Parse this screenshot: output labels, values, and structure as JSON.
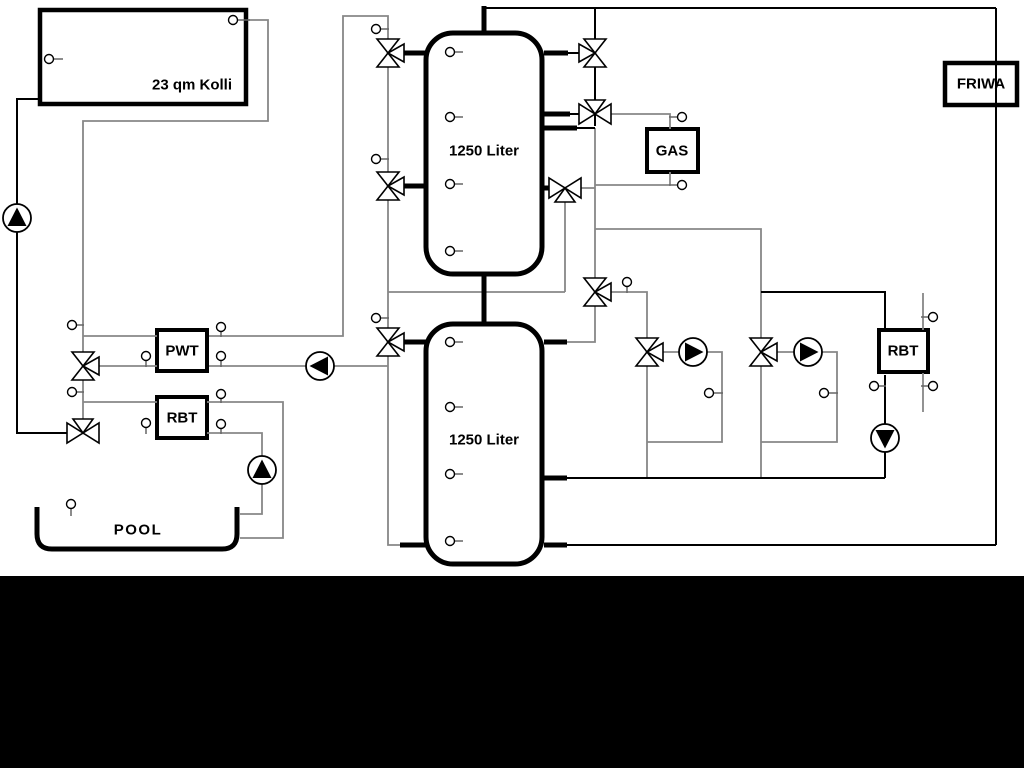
{
  "page": {
    "background": "#ffffff",
    "footer_bar_color": "#000000",
    "pipe_gray": "#878787",
    "pipe_black": "#000000",
    "component_fill": "#ffffff"
  },
  "diagram": {
    "labels": {
      "collector": "23 qm Kolli",
      "tank_top": "1250 Liter",
      "tank_bottom": "1250 Liter",
      "pwt": "PWT",
      "rbt_left": "RBT",
      "gas": "GAS",
      "friwa": "FRIWA",
      "rbt_right": "RBT",
      "pool": "POOL"
    },
    "components": {
      "pumps": [
        {
          "name": "solar-pump",
          "x": 17,
          "y": 218,
          "dir": "up"
        },
        {
          "name": "pwt-pump",
          "x": 320,
          "y": 366,
          "dir": "left"
        },
        {
          "name": "pool-pump",
          "x": 262,
          "y": 470,
          "dir": "up"
        },
        {
          "name": "heating-pump-1",
          "x": 693,
          "y": 352,
          "dir": "right"
        },
        {
          "name": "heating-pump-2",
          "x": 808,
          "y": 352,
          "dir": "right"
        },
        {
          "name": "rbt-pump",
          "x": 885,
          "y": 438,
          "dir": "down"
        }
      ],
      "valves": [
        {
          "name": "valve-buffer1-left-top",
          "x": 388,
          "y": 53,
          "t": "vR"
        },
        {
          "name": "valve-buffer1-left-mid",
          "x": 388,
          "y": 186,
          "t": "vR"
        },
        {
          "name": "valve-buffer2-left",
          "x": 388,
          "y": 342,
          "t": "vR"
        },
        {
          "name": "valve-solar-pwt",
          "x": 83,
          "y": 366,
          "t": "vR"
        },
        {
          "name": "valve-heating-supply",
          "x": 595,
          "y": 292,
          "t": "vR"
        },
        {
          "name": "valve-heating-circuit-1",
          "x": 647,
          "y": 352,
          "t": "vR"
        },
        {
          "name": "valve-heating-circuit-2",
          "x": 761,
          "y": 352,
          "t": "vR"
        },
        {
          "name": "valve-buffer1-right-top",
          "x": 595,
          "y": 53,
          "t": "vL"
        },
        {
          "name": "valve-gas-supply",
          "x": 595,
          "y": 114,
          "t": "hT"
        },
        {
          "name": "valve-buffer1-right-mid",
          "x": 565,
          "y": 188,
          "t": "hB"
        },
        {
          "name": "valve-solar-pool",
          "x": 83,
          "y": 433,
          "t": "hT"
        }
      ],
      "sensors": [
        {
          "x": 49,
          "y": 59,
          "ex": 63,
          "ey": 59
        },
        {
          "x": 233,
          "y": 20,
          "ex": 250,
          "ey": 20
        },
        {
          "x": 376,
          "y": 29,
          "ex": 389,
          "ey": 29
        },
        {
          "x": 376,
          "y": 159,
          "ex": 389,
          "ey": 159
        },
        {
          "x": 376,
          "y": 318,
          "ex": 389,
          "ey": 318
        },
        {
          "x": 72,
          "y": 325,
          "ex": 84,
          "ey": 325
        },
        {
          "x": 72,
          "y": 392,
          "ex": 84,
          "ey": 392
        },
        {
          "x": 146,
          "y": 356,
          "ex": 146,
          "ey": 367
        },
        {
          "x": 221,
          "y": 327,
          "ex": 221,
          "ey": 337
        },
        {
          "x": 221,
          "y": 356,
          "ex": 221,
          "ey": 367
        },
        {
          "x": 221,
          "y": 394,
          "ex": 221,
          "ey": 403
        },
        {
          "x": 146,
          "y": 423,
          "ex": 146,
          "ey": 434
        },
        {
          "x": 221,
          "y": 424,
          "ex": 221,
          "ey": 434
        },
        {
          "x": 71,
          "y": 504,
          "ex": 71,
          "ey": 516
        },
        {
          "x": 682,
          "y": 117,
          "ex": 669,
          "ey": 117
        },
        {
          "x": 682,
          "y": 185,
          "ex": 669,
          "ey": 185
        },
        {
          "x": 627,
          "y": 282,
          "ex": 627,
          "ey": 293
        },
        {
          "x": 709,
          "y": 393,
          "ex": 723,
          "ey": 393
        },
        {
          "x": 824,
          "y": 393,
          "ex": 838,
          "ey": 393
        },
        {
          "x": 933,
          "y": 317,
          "ex": 921,
          "ey": 317
        },
        {
          "x": 874,
          "y": 386,
          "ex": 886,
          "ey": 386
        },
        {
          "x": 933,
          "y": 386,
          "ex": 921,
          "ey": 386
        },
        {
          "x": 450,
          "y": 52,
          "ex": 463,
          "ey": 52
        },
        {
          "x": 450,
          "y": 117,
          "ex": 463,
          "ey": 117
        },
        {
          "x": 450,
          "y": 184,
          "ex": 463,
          "ey": 184
        },
        {
          "x": 450,
          "y": 251,
          "ex": 463,
          "ey": 251
        },
        {
          "x": 450,
          "y": 342,
          "ex": 463,
          "ey": 342
        },
        {
          "x": 450,
          "y": 407,
          "ex": 463,
          "ey": 407
        },
        {
          "x": 450,
          "y": 474,
          "ex": 463,
          "ey": 474
        },
        {
          "x": 450,
          "y": 541,
          "ex": 463,
          "ey": 541
        }
      ]
    }
  }
}
